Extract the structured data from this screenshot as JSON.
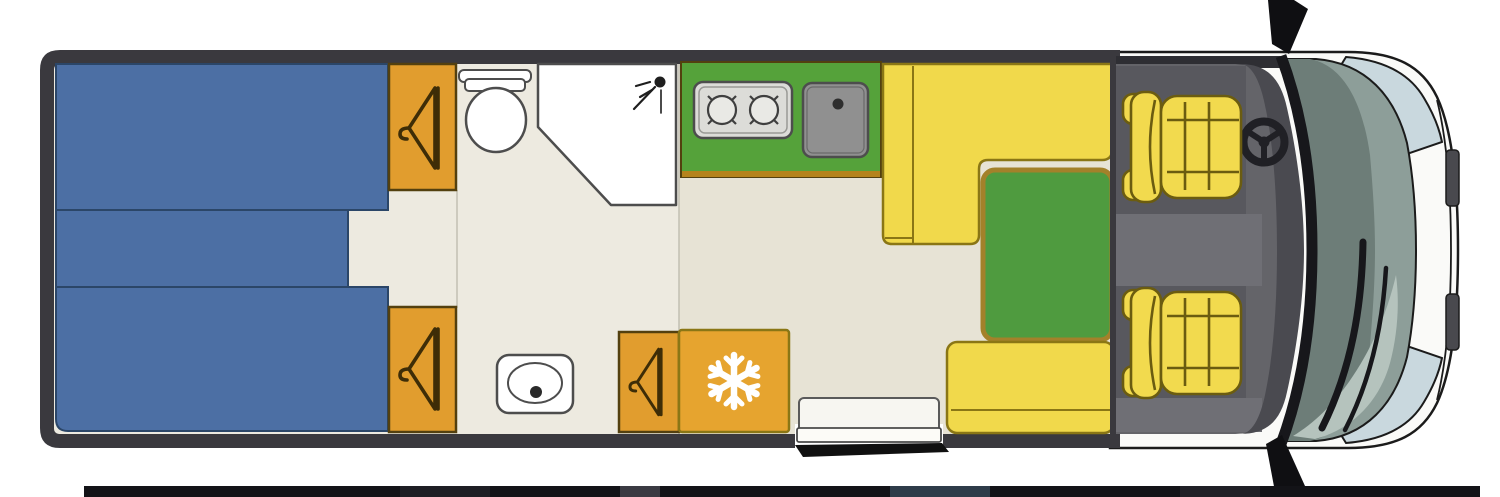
{
  "diagram": {
    "type": "motorhome-floorplan-top-view",
    "vehicle_front": "right",
    "second_plan_edge_visible_bottom": true
  },
  "colors": {
    "wall_dark": "#3a393e",
    "floor_light": "#EDEAE0",
    "floor_dark": "#E7E3D5",
    "partition_line": "#c2bfb2",
    "bed_blue": "#4C6FA4",
    "bed_line": "#2b4668",
    "wardrobe_orange": "#E19D2E",
    "wardrobe_border": "#53400f",
    "hanger_brown": "#3e2d07",
    "kitchen_green": "#55A23A",
    "kitchen_edge": "#b5831c",
    "stove_gray": "#dcdcd8",
    "sink_gray": "#909090",
    "fixture_white": "#ffffff",
    "fixture_stroke": "#4d4d4d",
    "table_green": "#4F9B3F",
    "table_border": "#a3812a",
    "bench_yellow": "#F1D94B",
    "bench_border": "#8a7615",
    "fridge_orange": "#E6A42F",
    "snowflake_white": "#ffffff",
    "seat_yellow": "#F2DA4E",
    "seat_border": "#6b5c10",
    "cab_floor": "#646469",
    "cab_platform": "#58585e",
    "cab_light_band": "#6f6f75",
    "dashboard_dark": "#4a4a50",
    "pillar_black": "#17171b",
    "wheel_black": "#202025",
    "glass_green": "#8d9e99",
    "glass_dark": "#6d7d78",
    "glass_light": "#b5c3bd",
    "body_white": "#fafaf8",
    "panel_blue": "#c9d8de",
    "accent_gray": "#49494e",
    "outline_black": "#1b1b1b",
    "mirror_black": "#0f0f12",
    "step_black": "#101010",
    "lower_plan_strip": "#131317"
  },
  "icons": {
    "hanger": "hanger-icon",
    "snowflake": "snowflake-icon",
    "shower_head": "shower-head-icon",
    "steering_wheel": "steering-wheel-icon",
    "mirror": "side-mirror-icon"
  },
  "areas": {
    "bed": "twin-beds",
    "wardrobe_top": "wardrobe",
    "wardrobe_bottom": "wardrobe",
    "toilet": "toilet",
    "shower": "corner-shower",
    "washbasin": "washbasin",
    "kitchen": "kitchen-counter",
    "stove": "two-burner-hob",
    "sink": "kitchen-sink",
    "dinette_bench": "l-shaped-dinette-bench",
    "table": "dinette-table",
    "side_bench": "side-bench",
    "hanger_cabinet": "small-wardrobe-cabinet",
    "fridge": "fridge-cabinet",
    "door": "entry-door-with-step",
    "driver_seat": "driver-swivel-seat",
    "passenger_seat": "passenger-swivel-seat",
    "cab": "driver-cab",
    "front": "vehicle-front"
  }
}
